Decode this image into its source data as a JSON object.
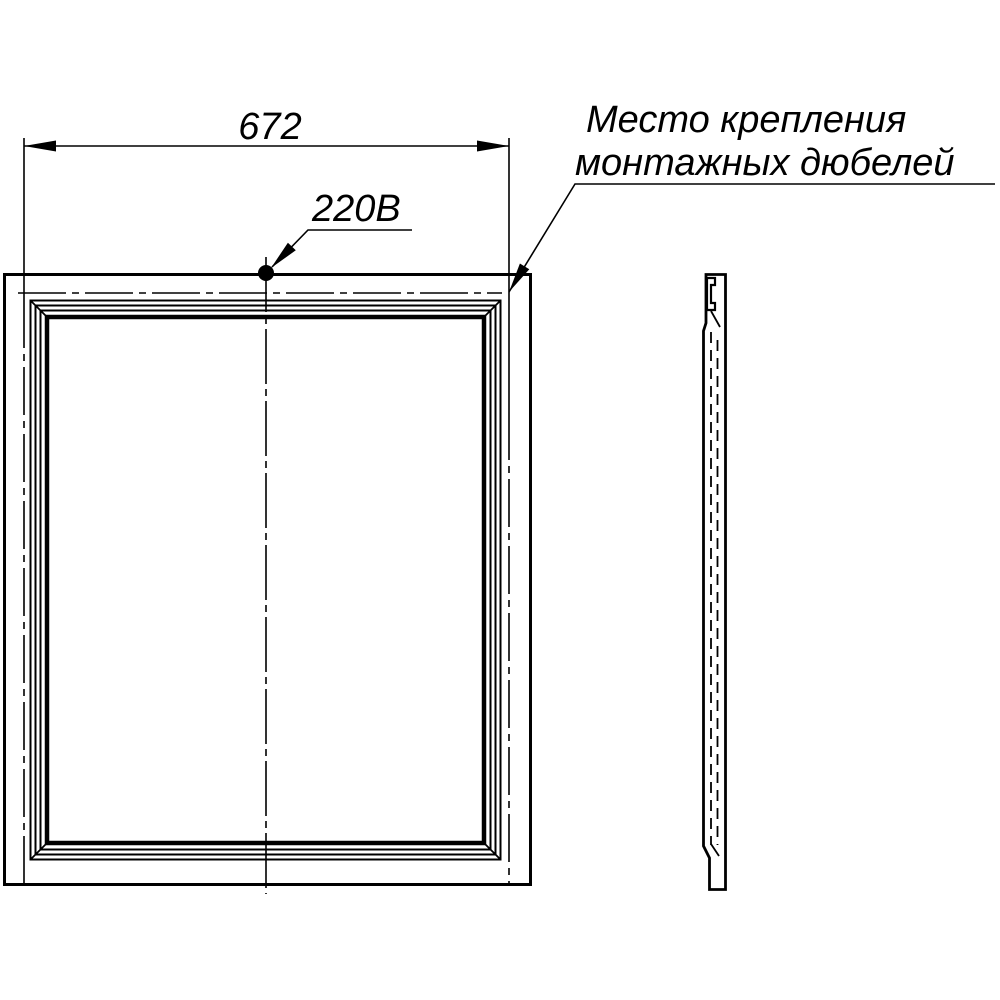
{
  "colors": {
    "line": "#000000",
    "background": "#ffffff"
  },
  "dimension": {
    "width_value": "672"
  },
  "labels": {
    "power": "220В",
    "mounting_line1": "Место крепления",
    "mounting_line2": "монтажных дюбелей"
  }
}
